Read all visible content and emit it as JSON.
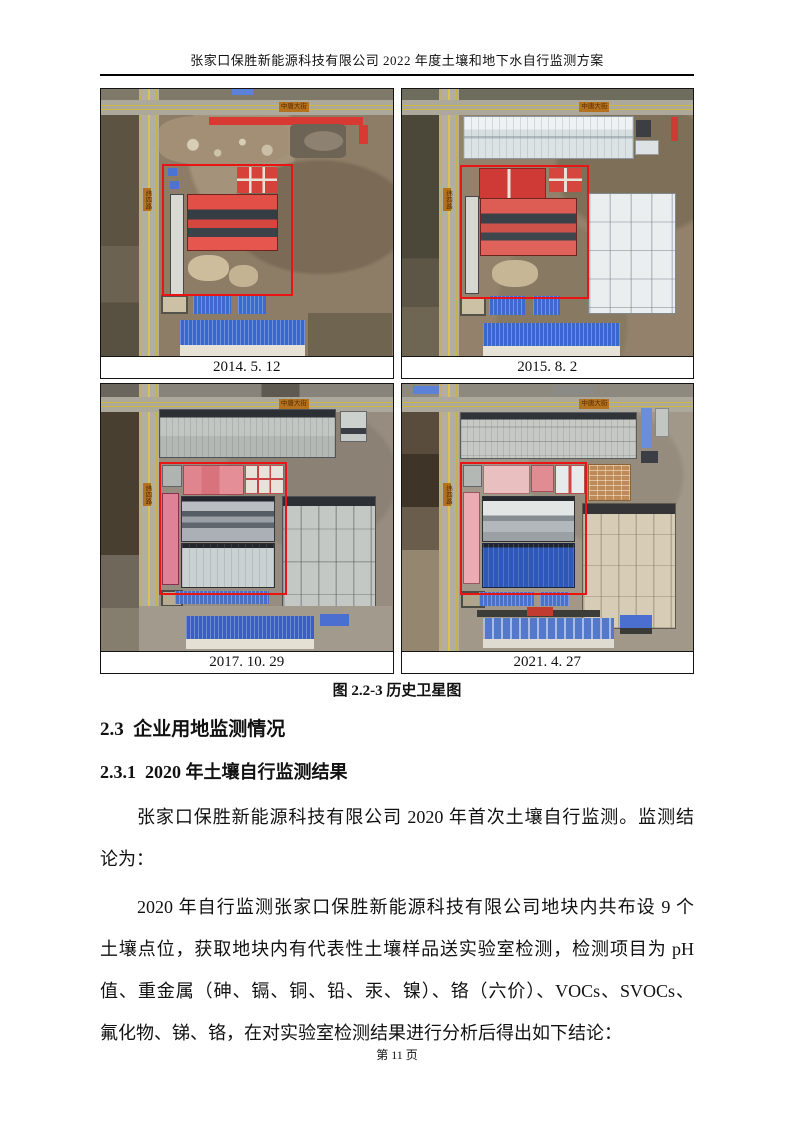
{
  "page": {
    "header_title": "张家口保胜新能源科技有限公司 2022 年度土壤和地下水自行监测方案",
    "footer_page_number": "第 11 页"
  },
  "figure": {
    "caption": "图 2.2-3 历史卫星图",
    "boundary_color": "#ea1414",
    "road_label_horizontal": "中唐大街",
    "road_label_vertical": "纬四路",
    "photos": [
      {
        "date": "2014. 5. 12"
      },
      {
        "date": "2015. 8. 2"
      },
      {
        "date": "2017. 10. 29"
      },
      {
        "date": "2021. 4. 27"
      }
    ]
  },
  "sections": {
    "heading_2_3": "2.3  企业用地监测情况",
    "heading_2_3_1": "2.3.1  2020 年土壤自行监测结果"
  },
  "body": {
    "p1_l1": "张家口保胜新能源科技有限公司 2020 年首次土壤自行监测。监测结",
    "p1_l2": "论为：",
    "p2_l1": "2020 年自行监测张家口保胜新能源科技有限公司地块内共布设 9 个",
    "p2_l2": "土壤点位，获取地块内有代表性土壤样品送实验室检测，检测项目为 pH",
    "p2_l3": "值、重金属（砷、镉、铜、铅、汞、镍）、铬（六价）、VOCs、SVOCs、",
    "p2_l4": "氟化物、锑、铬，在对实验室检测结果进行分析后得出如下结论："
  }
}
